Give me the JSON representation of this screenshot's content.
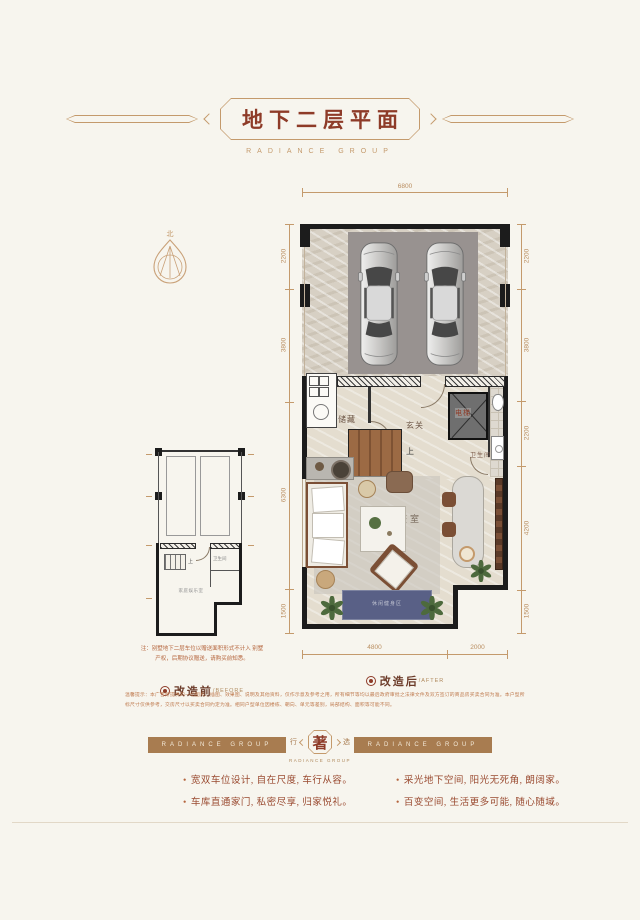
{
  "header": {
    "title": "地下二层平面",
    "subtitle": "RADIANCE GROUP"
  },
  "compass": {
    "north_label": "北"
  },
  "plan_after": {
    "rooms": {
      "storage": "储藏",
      "foyer": "玄关",
      "elevator": "电梯",
      "bathroom": "卫生间",
      "wine_room": "红酒品鉴室",
      "stairs_up": "上",
      "rug_zone": "休闲健身区"
    },
    "dims": {
      "top": [
        "6800"
      ],
      "bottom": [
        "4800",
        "2000"
      ],
      "left": [
        "2200",
        "3800",
        "6300",
        "1500"
      ],
      "right": [
        "2200",
        "3800",
        "2200",
        "4200",
        "1500"
      ]
    },
    "label": "改造后",
    "label_en": "/AFTER"
  },
  "plan_before": {
    "rooms": {
      "family_room": "家庭娱乐室",
      "bathroom": "卫生间",
      "stairs_up": "上"
    },
    "note": "注：别墅地下二层车位以赠送面积形式不计入 别墅产权，后期协议赠送，请购买前知悉。",
    "label": "改造前",
    "label_en": "/BEFORE"
  },
  "disclaimer": "温馨提示：本广告所提供的一切图片、插图、效果图、说明及其他资料，仅作示意及参考之用，所有细节等均以最后政府审批之法律文件及双方签订的商品房买卖合同为准。本户型所标尺寸仅供参考，交房尺寸以买卖合同约定为准。相同户型单位因楼栋、朝向、单元等差别，局部结构、面积等可能不同。",
  "banner": {
    "left_text": "RADIANCE GROUP",
    "right_text": "RADIANCE GROUP",
    "badge_left": "行",
    "badge_center": "著",
    "badge_right": "选",
    "badge_sub": "RADIANCE GROUP"
  },
  "bullets": {
    "dot": "•",
    "items": [
      "宽双车位设计, 自在尺度, 车行从容。",
      "车库直通家门, 私密尽享, 归家悦礼。",
      "采光地下空间, 阳光无死角, 朗阔家。",
      "百变空间, 生活更多可能, 随心随域。"
    ]
  }
}
